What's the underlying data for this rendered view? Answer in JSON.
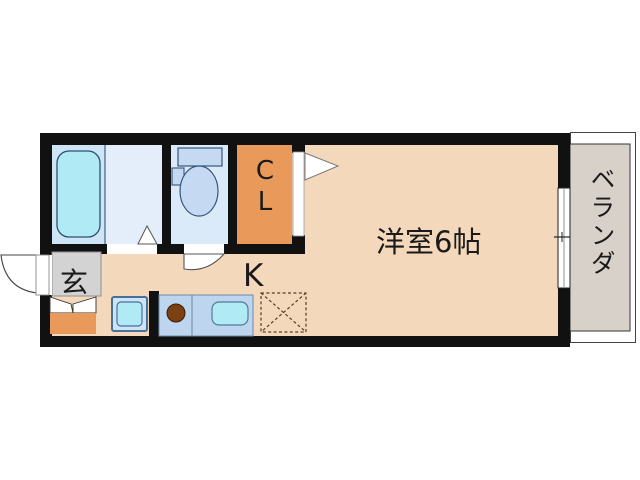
{
  "floorplan": {
    "type": "apartment-floor-plan",
    "rooms": {
      "western_room": {
        "label": "洋室6帖"
      },
      "kitchen": {
        "label": "K"
      },
      "closet": {
        "label": "CL"
      },
      "entrance": {
        "label": "玄"
      },
      "veranda": {
        "label": "ベランダ"
      }
    },
    "fixtures": [
      "bathtub-icon",
      "toilet-icon",
      "washer-pan-icon",
      "stove-burner-icon",
      "kitchen-sink-icon",
      "refrigerator-space-icon",
      "shoe-cabinet-icon",
      "entrance-door-swing-icon",
      "toilet-door-swing-icon",
      "folding-door-icon",
      "closet-door-swing-icon",
      "window-icon"
    ],
    "colors": {
      "wall": "#111111",
      "floor": "#f4d8bb",
      "closet_orange": "#e9995a",
      "bath_room": "#cde5f4",
      "washroom": "#e3eefa",
      "toilet_room": "#dbeaf8",
      "water_cyan": "#b0ebf5",
      "fixture_blue": "#c5daf2",
      "counter_blue": "#bdd5ee",
      "entrance_gray": "#d3d3d3",
      "veranda_gray": "#d8d1c9",
      "burner_brown": "#7c4012"
    }
  }
}
